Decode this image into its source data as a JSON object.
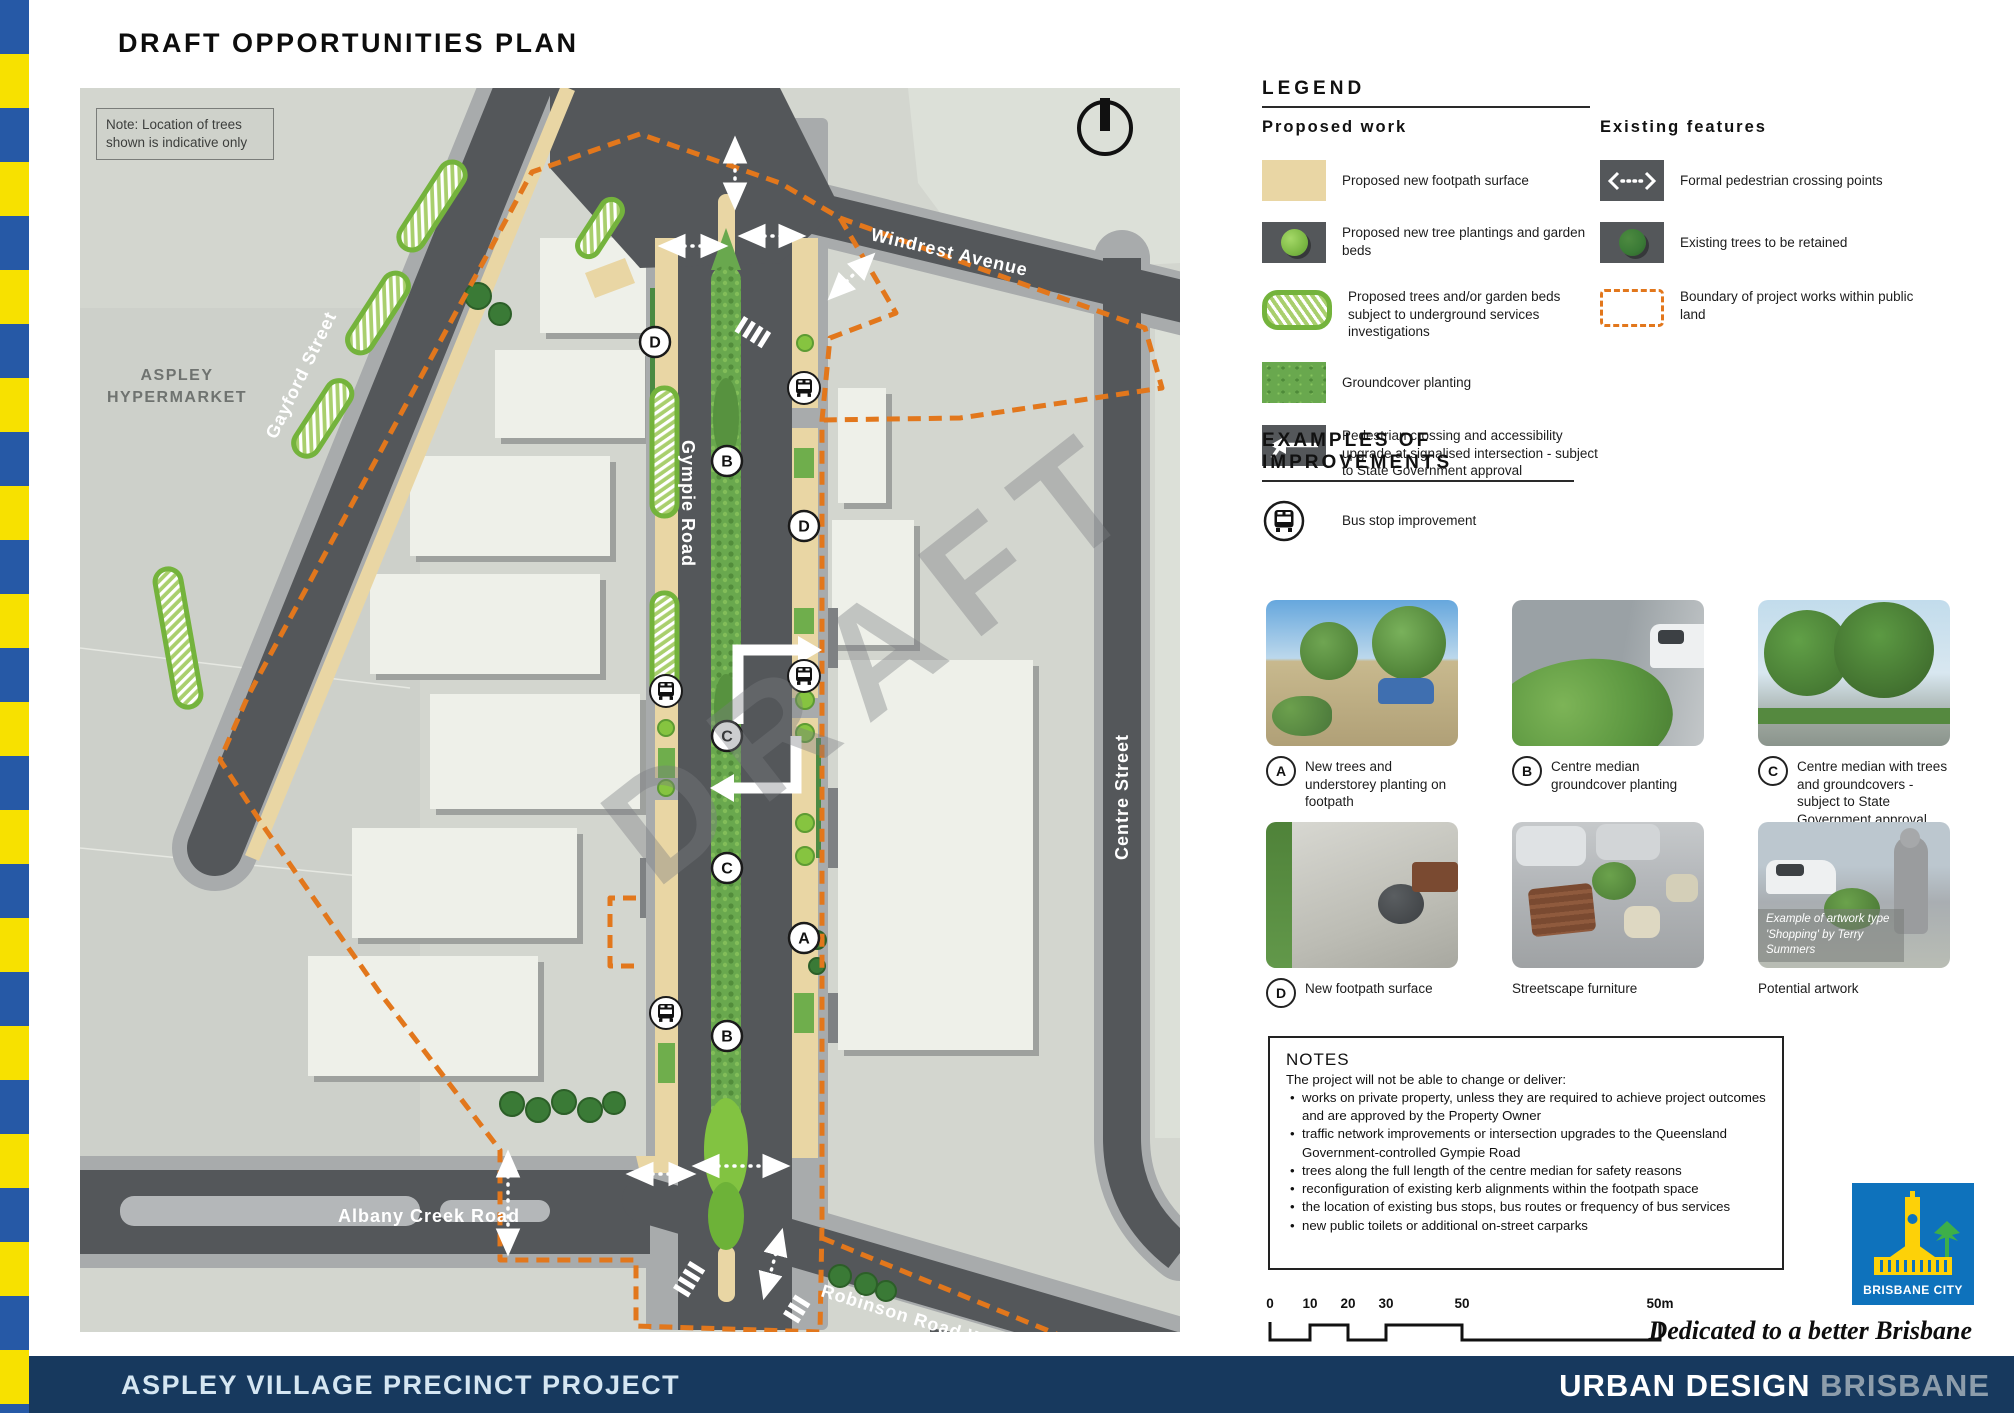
{
  "page": {
    "title": "DRAFT OPPORTUNITIES PLAN"
  },
  "colors": {
    "accent_orange": "#E2771C",
    "footer_navy": "#17395E",
    "strip_blue": "#2659A6",
    "strip_yellow": "#F7E100",
    "road_dark": "#54575A",
    "footpath_tan": "#E9D6A4",
    "green_median": "#69A84E",
    "green_proposed": "#8CC63F",
    "green_existing": "#3A7A36",
    "map_background": "#D3D6CF",
    "logo_blue": "#0E72BC"
  },
  "map": {
    "note": "Note: Location of trees shown is indicative only",
    "watermark": "DRAFT",
    "labels": {
      "hypermarket_line1": "ASPLEY",
      "hypermarket_line2": "HYPERMARKET",
      "gayford": "Gayford Street",
      "windrest": "Windrest Avenue",
      "gympie": "Gympie Road",
      "centre": "Centre Street",
      "albany": "Albany Creek Road",
      "robinson": "Robinson Road West"
    },
    "markers": [
      "D",
      "B",
      "D",
      "C",
      "C",
      "A",
      "B"
    ]
  },
  "legend": {
    "heading": "LEGEND",
    "proposed": {
      "heading": "Proposed work",
      "items": [
        {
          "label": "Proposed new footpath surface"
        },
        {
          "label": "Proposed new tree plantings and garden beds"
        },
        {
          "label": "Proposed trees and/or garden beds subject to underground services investigations"
        },
        {
          "label": "Groundcover planting"
        },
        {
          "label": "Pedestrian crossing and accessibility upgrade at signalised intersection - subject to State Government approval"
        },
        {
          "label": "Bus stop improvement"
        }
      ]
    },
    "existing": {
      "heading": "Existing features",
      "items": [
        {
          "label": "Formal pedestrian crossing points"
        },
        {
          "label": "Existing trees to be retained"
        },
        {
          "label": "Boundary of project works within public land"
        }
      ]
    }
  },
  "examples": {
    "heading": "EXAMPLES OF IMPROVEMENTS",
    "items": [
      {
        "letter": "A",
        "caption": "New trees and understorey planting on footpath"
      },
      {
        "letter": "B",
        "caption": "Centre median groundcover planting"
      },
      {
        "letter": "C",
        "caption": "Centre median with trees and groundcovers - subject to State Government approval"
      },
      {
        "letter": "D",
        "caption": "New footpath surface"
      },
      {
        "letter": "",
        "caption": "Streetscape furniture"
      },
      {
        "letter": "",
        "caption": "Potential artwork"
      }
    ],
    "artwork_overlay_line1": "Example of artwork type",
    "artwork_overlay_line2": "'Shopping' by Terry Summers"
  },
  "notes": {
    "heading": "NOTES",
    "intro": "The project will not be able to change or deliver:",
    "bullets": [
      "works on private property, unless they are required to achieve project outcomes and are approved by the Property Owner",
      "traffic network improvements or intersection upgrades to the Queensland Government-controlled Gympie Road",
      "trees along the full length of the centre median for safety reasons",
      "reconfiguration of existing kerb alignments within the footpath space",
      "the location of existing bus stops, bus routes or frequency of bus services",
      "new public toilets or additional on-street carparks"
    ]
  },
  "scalebar": {
    "labels": [
      "0",
      "10",
      "20",
      "30",
      "50",
      "50m"
    ]
  },
  "branding": {
    "logo_text": "BRISBANE CITY",
    "tagline": "Dedicated to a better Brisbane"
  },
  "footer": {
    "left": "ASPLEY VILLAGE PRECINCT PROJECT",
    "right_primary": "URBAN DESIGN",
    "right_secondary": "BRISBANE"
  }
}
